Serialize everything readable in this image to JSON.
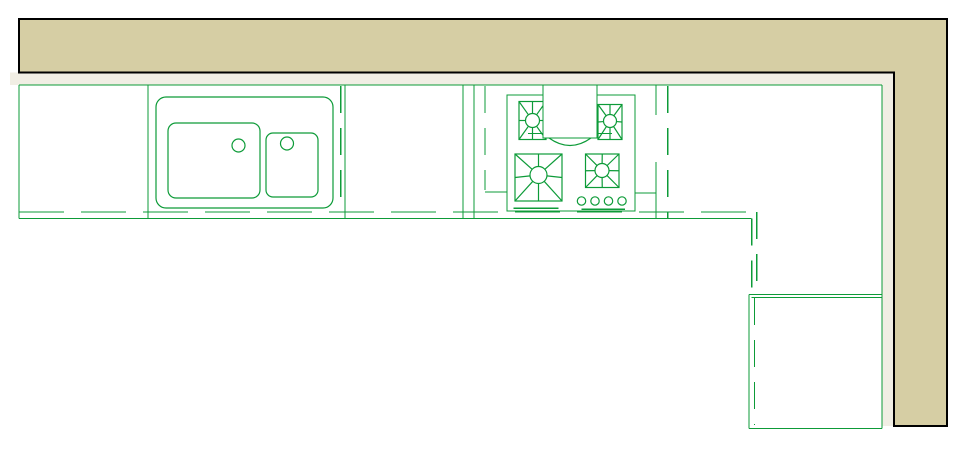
{
  "meta": {
    "title": "Kitchen CAD floor plan",
    "description": "Plan-view CAD drawing of an L-shaped kitchen: upper tan wall band, base cabinet run with double-bowl sink and four-burner gas cooktop with hood, dashed countertop edge lines, and a corner base cabinet at lower right."
  },
  "colors": {
    "wall_fill": "#d6cea4",
    "wall_outline": "#000000",
    "inner_band": "#f1eee4",
    "line_green": "#0d9b38",
    "hood_fill": "#ffffff",
    "background": "#ffffff"
  },
  "wall": {
    "outer_left": 19,
    "outer_top": 19,
    "outer_right": 947,
    "outer_bottom": 426,
    "inner_face_y": 72.5,
    "inner_face_x": 894
  },
  "cabinet_run": {
    "top_y": 85,
    "bottom_y": 218.5,
    "counter_dashed_y": 212,
    "right_x": 882,
    "solid_dividers_x": [
      19,
      148,
      345,
      463,
      474
    ],
    "broken_divider": {
      "x": 656,
      "segments": [
        [
          85,
          115
        ],
        [
          162,
          218.5
        ]
      ]
    },
    "dashed_lines": [
      {
        "x": 340.7,
        "y1": 86,
        "y2": 205
      },
      {
        "x": 485,
        "y1": 86,
        "y2": 190
      },
      {
        "x": 667.7,
        "y1": 86,
        "y2": 218
      }
    ]
  },
  "sink": {
    "counter_rect": {
      "x": 156,
      "y": 97,
      "w": 177,
      "h": 111,
      "r": 10
    },
    "large_basin": {
      "x": 168,
      "y": 123,
      "w": 92,
      "h": 75,
      "r": 8
    },
    "small_basin": {
      "x": 266,
      "y": 133,
      "w": 52,
      "h": 64,
      "r": 7
    },
    "drains": [
      {
        "cx": 238.5,
        "cy": 145.5,
        "r": 6.5
      },
      {
        "cx": 287,
        "cy": 143.5,
        "r": 6.5
      }
    ]
  },
  "cooktop": {
    "body": {
      "x": 507,
      "y": 95,
      "w": 128,
      "h": 116
    },
    "burners": [
      {
        "name": "burner-top-left",
        "rect": {
          "x": 519,
          "y": 101.5,
          "w": 27,
          "h": 38
        },
        "cx": 532.5,
        "cy": 120.5,
        "r": 7
      },
      {
        "name": "burner-top-right",
        "rect": {
          "x": 598,
          "y": 104.5,
          "w": 24,
          "h": 35
        },
        "cx": 610,
        "cy": 121,
        "r": 6.5
      },
      {
        "name": "burner-bottom-left",
        "rect": {
          "x": 515,
          "y": 154,
          "w": 47,
          "h": 47
        },
        "cx": 538.5,
        "cy": 175,
        "r": 8.5
      },
      {
        "name": "burner-bottom-right",
        "rect": {
          "x": 585.5,
          "y": 154,
          "w": 33.5,
          "h": 33.5
        },
        "cx": 602,
        "cy": 170.5,
        "r": 7
      }
    ],
    "knobs": {
      "cy": 201,
      "r": 4.2,
      "cx": [
        581.5,
        595,
        608.5,
        622
      ]
    },
    "trim_lines": [
      [
        513.5,
        208.3,
        558.5,
        208.3
      ],
      [
        581.7,
        209.3,
        625,
        209.3
      ]
    ],
    "hood": {
      "rect": {
        "x": 543,
        "y": 85,
        "w": 54,
        "h": 53
      },
      "stub_y": 133.5,
      "stub_left": [
        528,
        543
      ],
      "stub_right": [
        597,
        612
      ],
      "arc": {
        "x1": 549,
        "x2": 591,
        "y": 138,
        "depth": 15
      }
    }
  },
  "corner_cabinet": {
    "left_x": 749,
    "right_x": 882,
    "top_y1": 294.5,
    "top_y2": 297.5,
    "bottom_y": 428.5,
    "dashed_turn_x1": 751.7,
    "dashed_turn_x2": 756.7,
    "inner_dashed_x": 754.5
  }
}
